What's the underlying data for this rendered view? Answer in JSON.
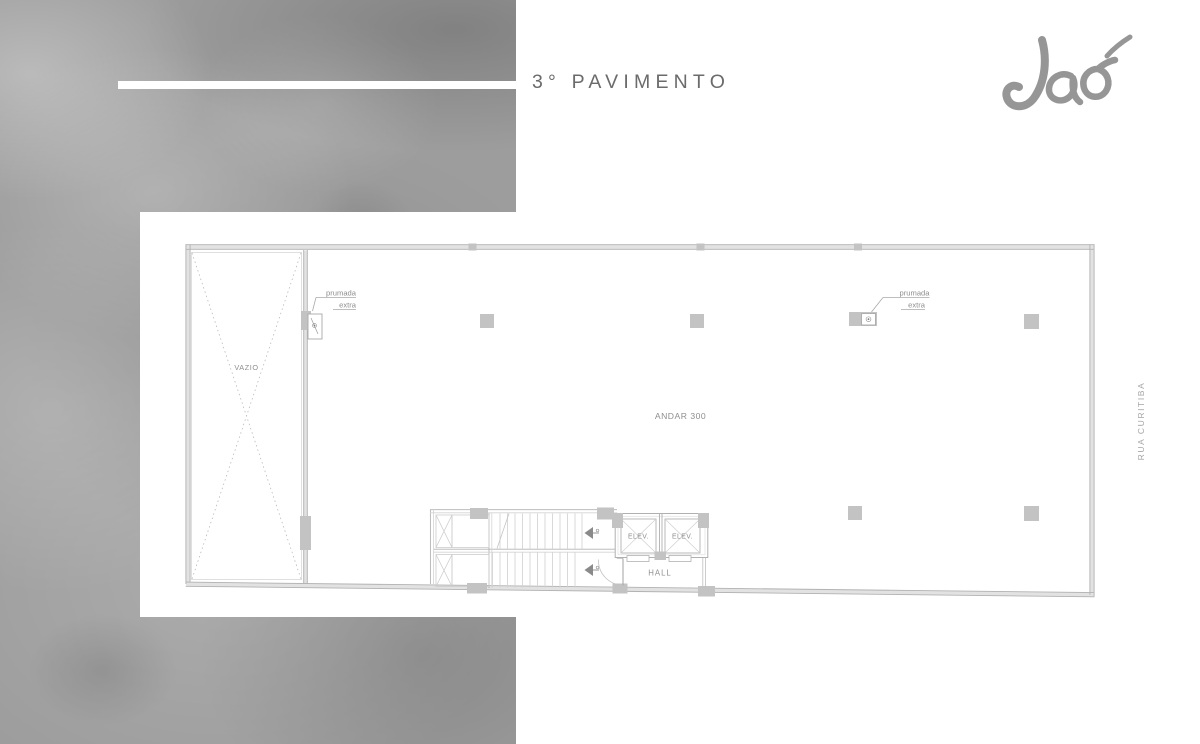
{
  "header": {
    "title": "3° PAVIMENTO",
    "logo_text": "Jaó"
  },
  "side": {
    "street_label": "RUA CURITIBA"
  },
  "plan": {
    "floor_label": "ANDAR 300",
    "void_label": "VAZIO",
    "hall_label": "HALL",
    "elevators": [
      "ELEV.",
      "ELEV."
    ],
    "riser_left": {
      "line1": "prumada",
      "line2": "extra"
    },
    "riser_right": {
      "line1": "prumada",
      "line2": "extra"
    }
  },
  "colors": {
    "texture_base": "#9d9d9d",
    "wall_line": "#b2b2b2",
    "column_fill": "#c3c3c3",
    "plan_label": "#8e8e8e",
    "title_text": "#6b6b6b",
    "logo_gray": "#8d8d8d",
    "street_text": "#a6a6a6"
  }
}
